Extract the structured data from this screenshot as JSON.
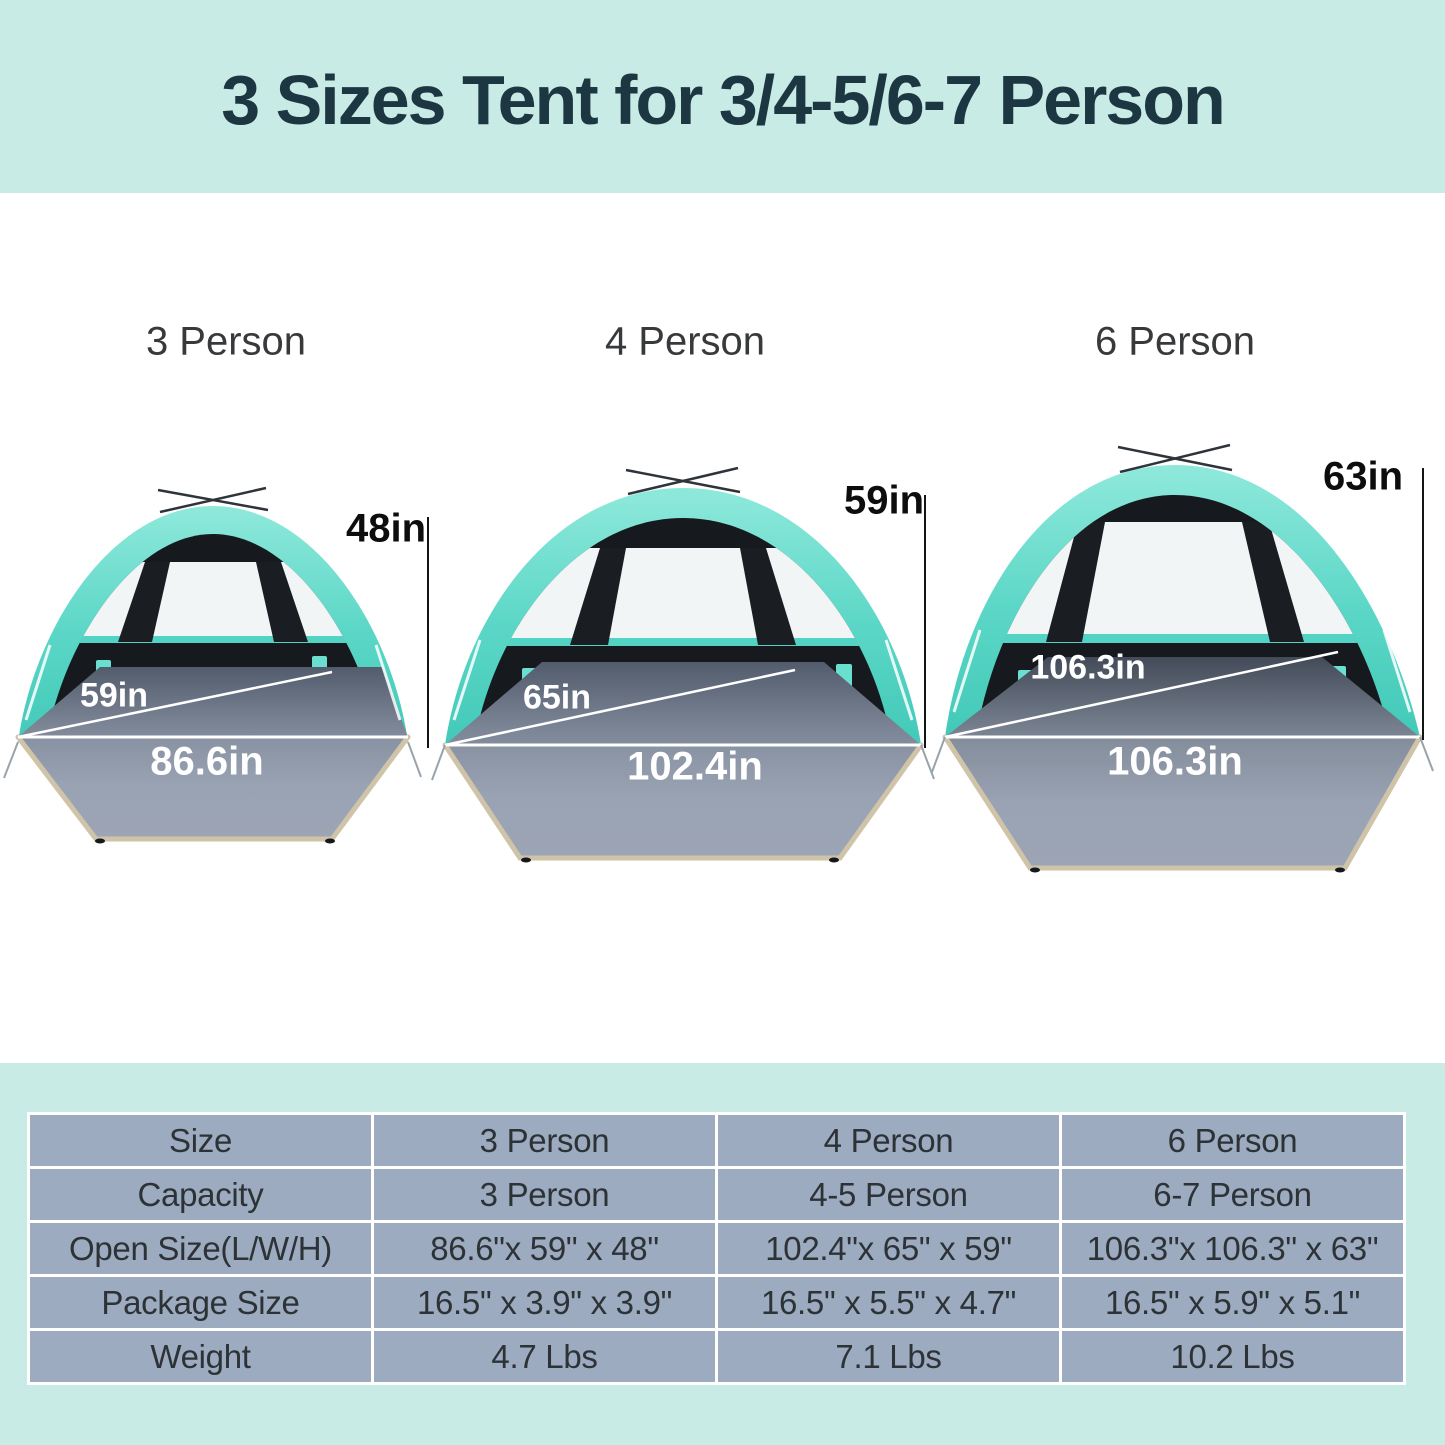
{
  "header": {
    "title": "3 Sizes Tent for 3/4-5/6-7 Person"
  },
  "tents": [
    {
      "label": "3 Person",
      "height": "48in",
      "depth": "59in",
      "width": "86.6in"
    },
    {
      "label": "4 Person",
      "height": "59in",
      "depth": "65in",
      "width": "102.4in"
    },
    {
      "label": "6 Person",
      "height": "63in",
      "depth": "106.3in",
      "width": "106.3in"
    }
  ],
  "colors": {
    "banner_bg": "#c8ebe5",
    "title_text": "#1c3642",
    "canopy_turquoise": "#54d4c4",
    "canopy_highlight": "#8fe9db",
    "tent_interior": "#16191d",
    "floor_gray_top": "#5f6878",
    "floor_gray_bottom": "#9aa3b4",
    "floor_trim_tan": "#cfc3a8",
    "table_cell_bg": "#9cabbf",
    "table_text": "#2d3237"
  },
  "table": {
    "rows": [
      {
        "label": "Size",
        "values": [
          "3 Person",
          "4 Person",
          "6 Person"
        ]
      },
      {
        "label": "Capacity",
        "values": [
          "3 Person",
          "4-5 Person",
          "6-7 Person"
        ]
      },
      {
        "label": "Open Size(L/W/H)",
        "values": [
          "86.6\"x 59\" x 48\"",
          "102.4\"x 65\" x 59\"",
          "106.3\"x 106.3\" x 63\""
        ]
      },
      {
        "label": "Package Size",
        "values": [
          "16.5\" x 3.9\" x 3.9\"",
          "16.5\" x 5.5\" x 4.7\"",
          "16.5\" x 5.9\" x 5.1\""
        ]
      },
      {
        "label": "Weight",
        "values": [
          "4.7 Lbs",
          "7.1 Lbs",
          "10.2 Lbs"
        ]
      }
    ]
  }
}
